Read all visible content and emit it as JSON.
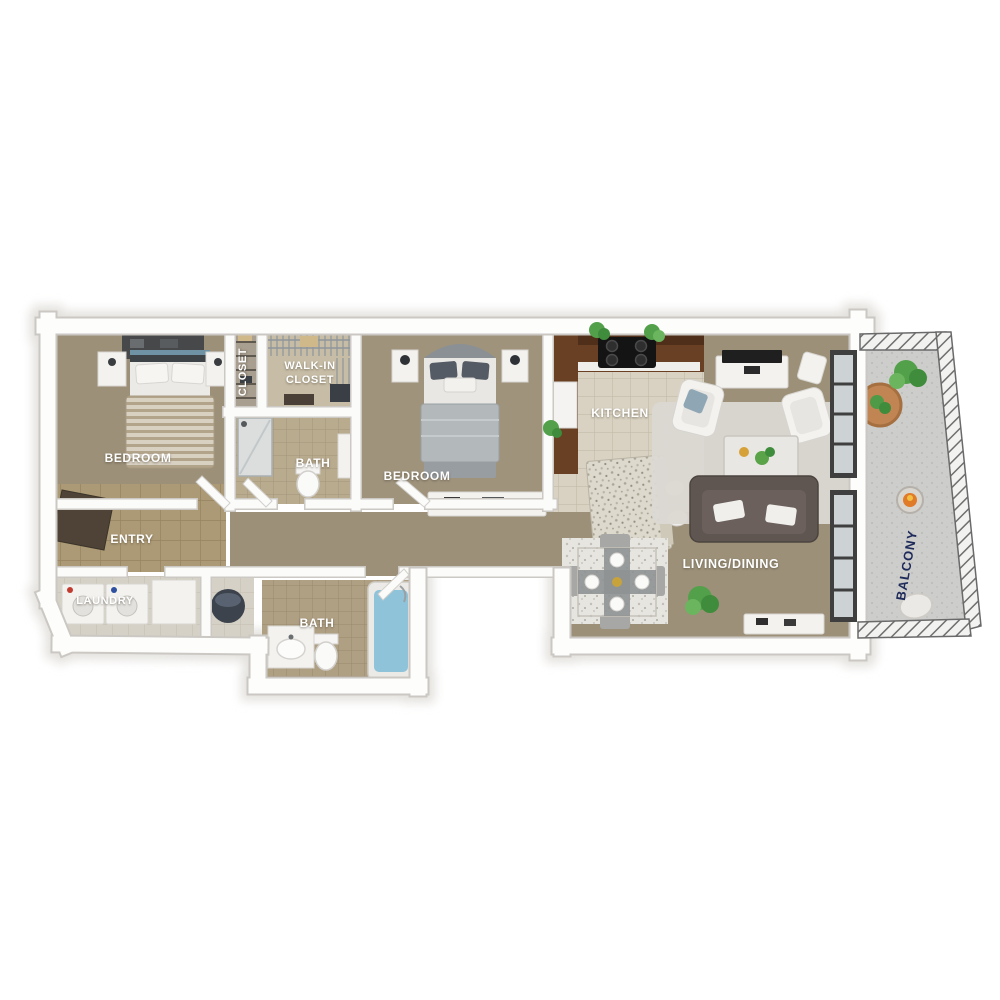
{
  "labels": {
    "bedroom_left": "BEDROOM",
    "closet": "CLOSET",
    "walk_in_closet_line1": "WALK-IN",
    "walk_in_closet_line2": "CLOSET",
    "bath_top": "BATH",
    "bedroom_middle": "BEDROOM",
    "kitchen": "KITCHEN",
    "entry": "ENTRY",
    "laundry": "LAUNDRY",
    "bath_bottom": "BATH",
    "living_dining": "LIVING/DINING",
    "balcony": "BALCONY"
  },
  "colors": {
    "background": "#ffffff",
    "wall_white": "#fdfdfc",
    "carpet_tan": "#9c9078",
    "kitchen_tile": "#d9d2c2",
    "entry_tile": "#b2a07c",
    "bath_tile": "#b9ab8e",
    "counter_wood": "#6a4024",
    "sofa_dark": "#5f5551",
    "tub_water_blue": "#8fc3da",
    "plant_green": "#53a04b",
    "railing_gray": "#787878",
    "balcony_label_navy": "#1e2a5a",
    "label_white": "#ffffff"
  }
}
